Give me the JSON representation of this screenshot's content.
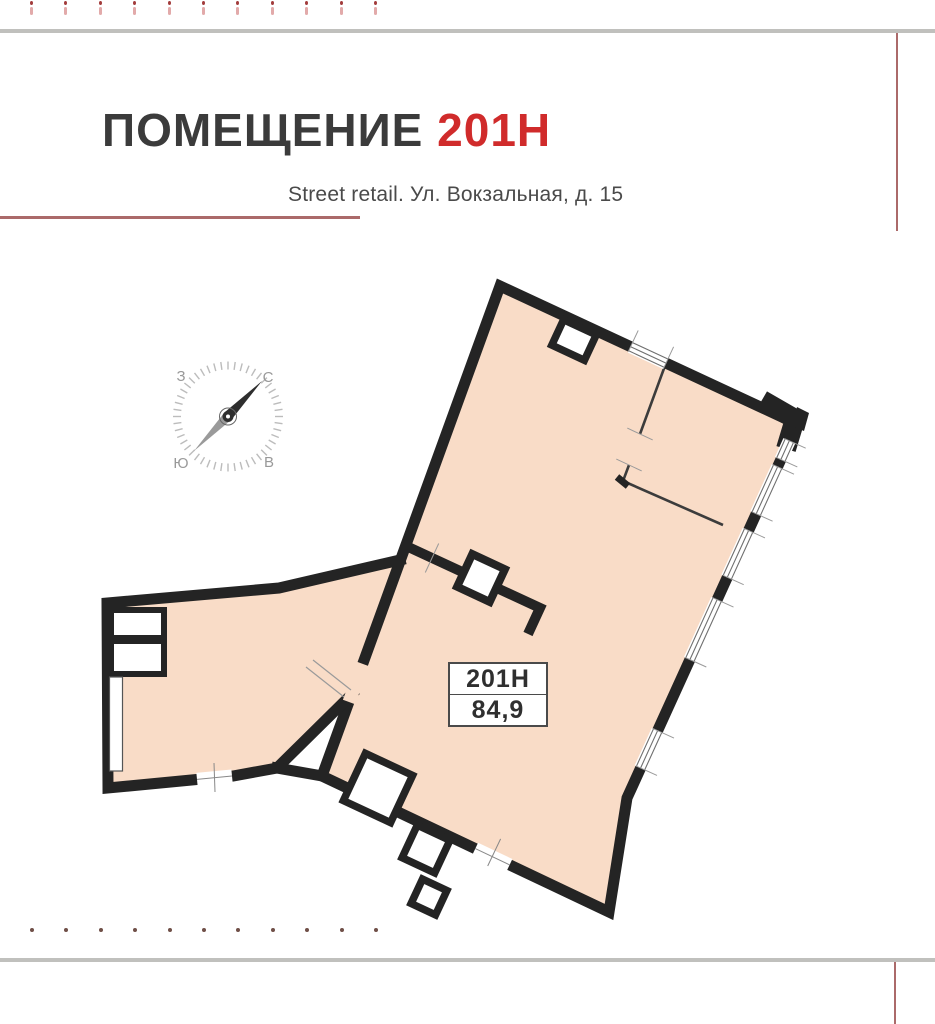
{
  "header": {
    "title_main": "ПОМЕЩЕНИЕ",
    "title_number": "201Н",
    "subtitle": "Street retail. Ул. Вокзальная, д. 15"
  },
  "compass": {
    "north": "С",
    "south": "Ю",
    "west": "З",
    "east": "В"
  },
  "plan": {
    "unit_label": "201Н",
    "area_value": "84,9"
  },
  "colors": {
    "accent_red": "#d02b2b",
    "floor_fill": "#f9dcc7",
    "wall_black": "#242424",
    "muted_red": "#ab6a6a",
    "rule_gray": "#c0c0bd"
  },
  "decor": {
    "top_marks_count": 11,
    "bottom_dots_count": 11
  }
}
